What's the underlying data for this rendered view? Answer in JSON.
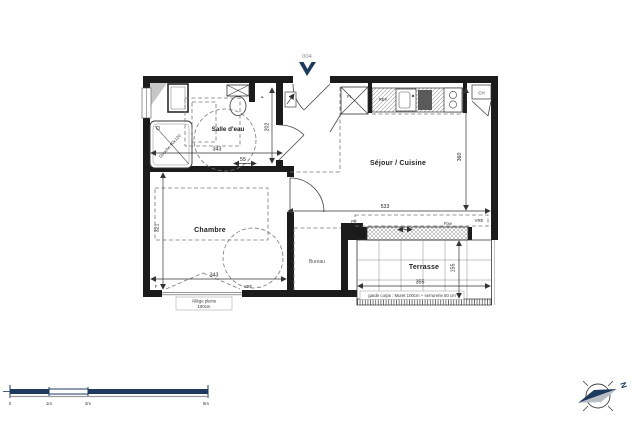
{
  "plan": {
    "unit_number": "004",
    "rooms": {
      "salle_deau": "Salle d'eau",
      "sejour_cuisine": "Séjour / Cuisine",
      "chambre": "Chambre",
      "bureau": "Bureau",
      "terrasse": "Terrasse"
    },
    "fixtures": {
      "shower": "Douche 90x120",
      "closet": "PL",
      "fridge": "REF",
      "water_heater": "CH"
    },
    "window_labels": {
      "entry_f": "F",
      "terrace_pf": "PF",
      "terrace_fixe": "Fixe",
      "terrace_vre": "VRE",
      "chambre_f": "F",
      "chambre_vre": "VRE"
    },
    "dimensions": {
      "salle_deau_width": "343",
      "salle_deau_nook": "55",
      "entry_depth": "202",
      "sejour_width": "533",
      "sejour_height": "360",
      "chambre_height": "321",
      "chambre_width": "343",
      "terrasse_width": "355",
      "terrasse_depth": "155"
    },
    "notes": {
      "allege_line1": "Allège pleine",
      "allege_line2": "100cm",
      "garde_corps": "garde corps : Muret 100cm + serrurerie 50 cm"
    }
  },
  "scale_bar": {
    "labels": [
      "0",
      "1m",
      "2m",
      "5m"
    ]
  },
  "compass": {
    "north": "N"
  },
  "colors": {
    "accent": "#1e3a5c",
    "wall": "#1b1b1b"
  }
}
